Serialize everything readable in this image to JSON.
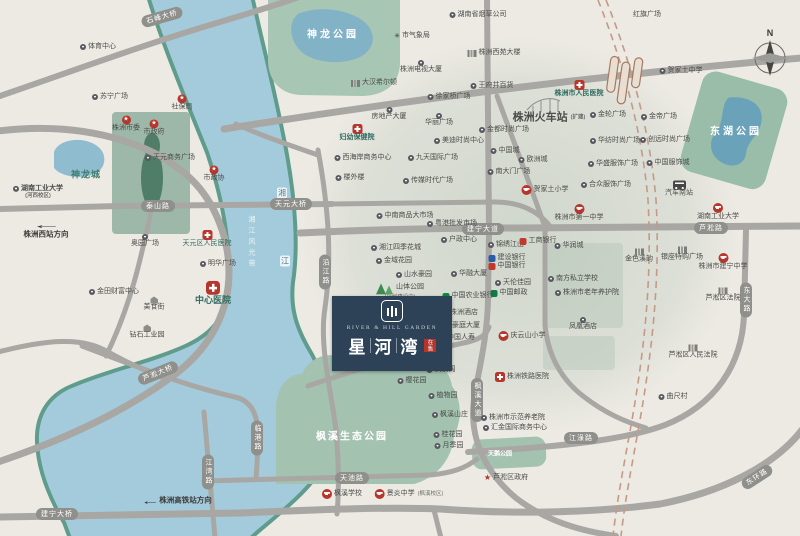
{
  "property_badge": {
    "en_name": "RIVER & HILL GARDEN",
    "cn_chars": [
      "星",
      "河",
      "湾"
    ],
    "tag": "在售"
  },
  "compass": {
    "letter": "N"
  },
  "directions": [
    {
      "text": "株洲西站方向",
      "x": 46,
      "y": 230,
      "arrow": "above"
    },
    {
      "text": "株洲高铁站方向",
      "x": 178,
      "y": 500,
      "arrow": "left"
    }
  ],
  "area_labels": [
    {
      "text": "神龙公园",
      "x": 333,
      "y": 33,
      "size": 10,
      "ls": 3,
      "cls": ""
    },
    {
      "text": "东湖公园",
      "x": 736,
      "y": 130,
      "size": 10,
      "ls": 3,
      "cls": ""
    },
    {
      "text": "枫溪生态公园",
      "x": 352,
      "y": 435,
      "size": 10,
      "ls": 2,
      "cls": ""
    },
    {
      "text": "天鹅公园",
      "x": 500,
      "y": 453,
      "size": 6,
      "ls": 0,
      "cls": ""
    },
    {
      "text": "神龙城",
      "x": 86,
      "y": 174,
      "size": 9,
      "ls": 1,
      "cls": "tealtxt"
    },
    {
      "text": "湘江风光带",
      "x": 251,
      "y": 243,
      "size": 7,
      "ls": 4,
      "cls": "band"
    },
    {
      "text": "湘",
      "x": 282,
      "y": 193,
      "size": 8,
      "ls": 0,
      "cls": "riverchip"
    },
    {
      "text": "江",
      "x": 285,
      "y": 261,
      "size": 8,
      "ls": 0,
      "cls": "riverchip"
    }
  ],
  "road_labels": [
    {
      "text": "石峰大桥",
      "x": 162,
      "y": 17,
      "rot": -16
    },
    {
      "text": "泰山路",
      "x": 158,
      "y": 206
    },
    {
      "text": "天元大桥",
      "x": 291,
      "y": 204
    },
    {
      "text": "建宁大道",
      "x": 483,
      "y": 229
    },
    {
      "text": "芦淞路",
      "x": 711,
      "y": 228
    },
    {
      "text": "东大路",
      "x": 746,
      "y": 300,
      "vert": 1
    },
    {
      "text": "沿江路",
      "x": 325,
      "y": 272,
      "vert": 1
    },
    {
      "text": "株董路",
      "x": 393,
      "y": 358,
      "teal": 1
    },
    {
      "text": "枫溪大道",
      "x": 477,
      "y": 400,
      "vert": 1
    },
    {
      "text": "天池路",
      "x": 352,
      "y": 478
    },
    {
      "text": "江湾路",
      "x": 208,
      "y": 472,
      "vert": 1
    },
    {
      "text": "临港路",
      "x": 257,
      "y": 438,
      "vert": 1
    },
    {
      "text": "江淥路",
      "x": 581,
      "y": 438
    },
    {
      "text": "东环路",
      "x": 757,
      "y": 477,
      "rot": -33
    },
    {
      "text": "建宁大桥",
      "x": 57,
      "y": 514
    },
    {
      "text": "芦淞大桥",
      "x": 158,
      "y": 373,
      "rot": -22
    }
  ],
  "pois": [
    {
      "t": "体育中心",
      "x": 98,
      "y": 47,
      "i": "dot"
    },
    {
      "t": "苏宁广场",
      "x": 110,
      "y": 97,
      "i": "dot"
    },
    {
      "t": "社保局",
      "x": 182,
      "y": 103,
      "i": "gov",
      "p": "a"
    },
    {
      "t": "株洲市委",
      "x": 126,
      "y": 124,
      "i": "gov",
      "p": "a"
    },
    {
      "t": "市政府",
      "x": 154,
      "y": 128,
      "i": "gov",
      "p": "a"
    },
    {
      "t": "天元商务广场",
      "x": 170,
      "y": 158,
      "i": "dot"
    },
    {
      "t": "市政协",
      "x": 214,
      "y": 174,
      "i": "gov",
      "p": "a"
    },
    {
      "t": "湖南工业大学",
      "x": 38,
      "y": 192,
      "i": "dot",
      "b": 1,
      "sub": "(河西校区)"
    },
    {
      "t": "奥园广场",
      "x": 145,
      "y": 241,
      "i": "dot",
      "p": "a"
    },
    {
      "t": "天元区人民医院",
      "x": 207,
      "y": 239,
      "i": "hosp",
      "p": "a",
      "c": "teal"
    },
    {
      "t": "明华广场",
      "x": 218,
      "y": 264,
      "i": "dot"
    },
    {
      "t": "中心医院",
      "x": 213,
      "y": 293,
      "i": "hosp-lg",
      "p": "a",
      "b": 1,
      "s": 9,
      "c": "teal"
    },
    {
      "t": "金田财富中心",
      "x": 114,
      "y": 292,
      "i": "dot"
    },
    {
      "t": "美食街",
      "x": 154,
      "y": 304,
      "i": "house",
      "p": "a"
    },
    {
      "t": "钻石工业园",
      "x": 147,
      "y": 332,
      "i": "house",
      "p": "a"
    },
    {
      "t": "市气象局",
      "x": 412,
      "y": 36,
      "i": "asterisk"
    },
    {
      "t": "湖南省烟草公司",
      "x": 478,
      "y": 15,
      "i": "dot"
    },
    {
      "t": "红旗广场",
      "x": 647,
      "y": 15
    },
    {
      "t": "株洲电视大厦",
      "x": 421,
      "y": 67,
      "i": "dot",
      "p": "a"
    },
    {
      "t": "大汉希尔顿",
      "x": 374,
      "y": 83,
      "i": "bld"
    },
    {
      "t": "株洲西苑大楼",
      "x": 494,
      "y": 53,
      "i": "bld"
    },
    {
      "t": "王府井百货",
      "x": 492,
      "y": 86,
      "i": "dot"
    },
    {
      "t": "房地产大厦",
      "x": 389,
      "y": 114,
      "i": "dot",
      "p": "a"
    },
    {
      "t": "妇幼保健院",
      "x": 357,
      "y": 133,
      "i": "hosp",
      "p": "a",
      "b": 1,
      "c": "teal"
    },
    {
      "t": "徐家桥广场",
      "x": 449,
      "y": 97,
      "i": "dot"
    },
    {
      "t": "华丽广场",
      "x": 439,
      "y": 120,
      "i": "dot",
      "p": "a"
    },
    {
      "t": "美迪时尚中心",
      "x": 459,
      "y": 141,
      "i": "dot"
    },
    {
      "t": "金都时尚广场",
      "x": 504,
      "y": 130,
      "i": "dot"
    },
    {
      "t": "中国城",
      "x": 505,
      "y": 151,
      "i": "dot"
    },
    {
      "t": "西海岸商务中心",
      "x": 363,
      "y": 158,
      "i": "dot"
    },
    {
      "t": "九天国际广场",
      "x": 433,
      "y": 158,
      "i": "dot"
    },
    {
      "t": "楼外楼",
      "x": 350,
      "y": 178,
      "i": "dot"
    },
    {
      "t": "传媒时代广场",
      "x": 428,
      "y": 181,
      "i": "dot"
    },
    {
      "t": "株洲市人民医院",
      "x": 579,
      "y": 89,
      "i": "hosp",
      "p": "a",
      "b": 1,
      "c": "teal"
    },
    {
      "t": "株洲火车站",
      "x": 549,
      "y": 118,
      "s": 11,
      "b": 1,
      "tail": "(扩建)"
    },
    {
      "t": "贺家土中学",
      "x": 681,
      "y": 71,
      "i": "dot"
    },
    {
      "t": "金轮广场",
      "x": 608,
      "y": 115,
      "i": "dot"
    },
    {
      "t": "金帝广场",
      "x": 659,
      "y": 117,
      "i": "dot"
    },
    {
      "t": "华纺时尚广场",
      "x": 615,
      "y": 141,
      "i": "dot"
    },
    {
      "t": "创远时尚广场",
      "x": 665,
      "y": 140,
      "i": "dot"
    },
    {
      "t": "华盛服饰广场",
      "x": 613,
      "y": 164,
      "i": "dot"
    },
    {
      "t": "中国服饰城",
      "x": 668,
      "y": 163,
      "i": "dot"
    },
    {
      "t": "欧洲城",
      "x": 533,
      "y": 160,
      "i": "dot"
    },
    {
      "t": "南大门广场",
      "x": 509,
      "y": 172,
      "i": "dot"
    },
    {
      "t": "合众服饰广场",
      "x": 606,
      "y": 185,
      "i": "dot"
    },
    {
      "t": "贺家土小学",
      "x": 545,
      "y": 190,
      "i": "school"
    },
    {
      "t": "株洲市第一中学",
      "x": 579,
      "y": 213,
      "i": "school",
      "p": "a"
    },
    {
      "t": "汽车南站",
      "x": 679,
      "y": 189,
      "i": "bus",
      "p": "a"
    },
    {
      "t": "湖南工业大学",
      "x": 718,
      "y": 212,
      "i": "school",
      "p": "a"
    },
    {
      "t": "华润城",
      "x": 569,
      "y": 246,
      "i": "dot"
    },
    {
      "t": "金色溪韵",
      "x": 639,
      "y": 256,
      "i": "bld",
      "p": "a"
    },
    {
      "t": "银座特购广场",
      "x": 682,
      "y": 254,
      "i": "bld",
      "p": "a"
    },
    {
      "t": "株洲市建宁中学",
      "x": 723,
      "y": 262,
      "i": "school",
      "p": "a"
    },
    {
      "t": "芦淞区法院",
      "x": 723,
      "y": 295,
      "i": "bld",
      "p": "a"
    },
    {
      "t": "芦淞区人民法院",
      "x": 693,
      "y": 352,
      "i": "bld",
      "p": "a"
    },
    {
      "t": "南方私立学校",
      "x": 573,
      "y": 279,
      "i": "dot"
    },
    {
      "t": "株洲市老年养护院",
      "x": 587,
      "y": 293,
      "i": "dot"
    },
    {
      "t": "凤凰酒店",
      "x": 583,
      "y": 324,
      "i": "dot",
      "p": "a"
    },
    {
      "t": "曲尺村",
      "x": 673,
      "y": 397,
      "i": "dot"
    },
    {
      "t": "户政中心",
      "x": 459,
      "y": 240,
      "i": "dot"
    },
    {
      "t": "锦绣江山",
      "x": 506,
      "y": 245,
      "i": "dot"
    },
    {
      "t": "工商银行",
      "x": 538,
      "y": 241,
      "i": "bank-red"
    },
    {
      "t": "建设银行",
      "x": 507,
      "y": 258,
      "i": "bank-blue"
    },
    {
      "t": "中国银行",
      "x": 507,
      "y": 266,
      "i": "bank-red"
    },
    {
      "t": "天伦佳园",
      "x": 513,
      "y": 283,
      "i": "dot"
    },
    {
      "t": "中国邮政",
      "x": 509,
      "y": 293,
      "i": "post"
    },
    {
      "t": "华融大厦",
      "x": 469,
      "y": 274,
      "i": "dot"
    },
    {
      "t": "中国农业银行",
      "x": 468,
      "y": 296,
      "i": "bank-green"
    },
    {
      "t": "株洲酒店",
      "x": 460,
      "y": 313,
      "i": "dot"
    },
    {
      "t": "豪庭大厦",
      "x": 462,
      "y": 326,
      "i": "dot"
    },
    {
      "t": "中国人寿",
      "x": 457,
      "y": 338,
      "i": "dot"
    },
    {
      "t": "庆云山小学",
      "x": 522,
      "y": 336,
      "i": "school"
    },
    {
      "t": "湘江四季花城",
      "x": 396,
      "y": 248,
      "i": "dot"
    },
    {
      "t": "金域花园",
      "x": 394,
      "y": 261,
      "i": "dot"
    },
    {
      "t": "山水豪园",
      "x": 414,
      "y": 275,
      "i": "dot"
    },
    {
      "t": "山体公园",
      "x": 400,
      "y": 291,
      "i": "tree",
      "sub": "(规划建设中)"
    },
    {
      "t": "中南商品大市场",
      "x": 405,
      "y": 216,
      "i": "dot"
    },
    {
      "t": "粤港批发市场",
      "x": 452,
      "y": 224,
      "i": "dot"
    },
    {
      "t": "株洲铁路医院",
      "x": 522,
      "y": 377,
      "i": "hosp"
    },
    {
      "t": "樱花园",
      "x": 412,
      "y": 381,
      "i": "dot"
    },
    {
      "t": "枫溪阁",
      "x": 441,
      "y": 370,
      "i": "dot"
    },
    {
      "t": "植物园",
      "x": 443,
      "y": 396,
      "i": "dot"
    },
    {
      "t": "枫溪山庄",
      "x": 450,
      "y": 415,
      "i": "dot"
    },
    {
      "t": "桂花园",
      "x": 448,
      "y": 435,
      "i": "dot"
    },
    {
      "t": "月季园",
      "x": 449,
      "y": 446,
      "i": "dot"
    },
    {
      "t": "株洲市示范养老院",
      "x": 513,
      "y": 418,
      "i": "dot"
    },
    {
      "t": "汇金国际商务中心",
      "x": 515,
      "y": 428,
      "i": "dot"
    },
    {
      "t": "芦淞区政府",
      "x": 506,
      "y": 478,
      "i": "star"
    },
    {
      "t": "枫溪学校",
      "x": 342,
      "y": 494,
      "i": "school"
    },
    {
      "t": "景炎中学",
      "x": 409,
      "y": 494,
      "i": "school",
      "tail": "(枫溪校区)"
    }
  ]
}
